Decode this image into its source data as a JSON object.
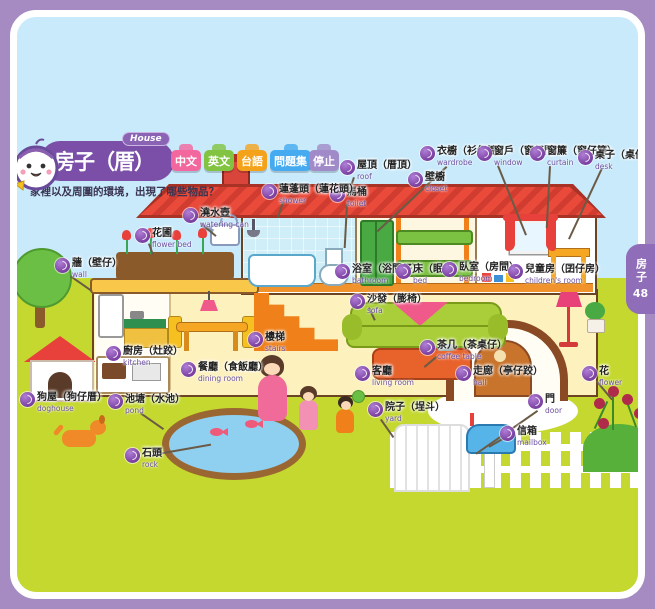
{
  "header": {
    "title": "房子（厝）",
    "title_en": "House",
    "subtitle": "家裡以及周圍的環境，出現了哪些物品？",
    "mascot_icon": "mascot-face",
    "buttons": [
      {
        "label": "中文",
        "color": "#f2679e"
      },
      {
        "label": "英文",
        "color": "#82c341"
      },
      {
        "label": "台語",
        "color": "#f5a21b"
      },
      {
        "label": "問題集",
        "color": "#45aaf0"
      },
      {
        "label": "停止",
        "color": "#a08bc8"
      }
    ]
  },
  "side_tab": {
    "title": "房子",
    "page_number": "48"
  },
  "labels": [
    {
      "zh": "屋頂（厝頂）",
      "en": "roof"
    },
    {
      "zh": "衣櫥（衫仔櫥）",
      "en": "wardrobe"
    },
    {
      "zh": "窗戶（窗仔門）",
      "en": "window"
    },
    {
      "zh": "窗簾（窗仔簾）",
      "en": "curtain"
    },
    {
      "zh": "桌子（桌仔）",
      "en": "desk"
    },
    {
      "zh": "壁櫥",
      "en": "closet"
    },
    {
      "zh": "馬桶",
      "en": "toilet"
    },
    {
      "zh": "蓮蓬頭（蓮花頭）",
      "en": "shower"
    },
    {
      "zh": "澆水壺",
      "en": "watering can"
    },
    {
      "zh": "花圃",
      "en": "flower bed"
    },
    {
      "zh": "牆（壁仔）",
      "en": "wall"
    },
    {
      "zh": "浴室（浴間仔）",
      "en": "bathroom"
    },
    {
      "zh": "床（眠床）",
      "en": "bed"
    },
    {
      "zh": "臥室（房間）",
      "en": "bedroom"
    },
    {
      "zh": "兒童房（囝仔房）",
      "en": "children's room"
    },
    {
      "zh": "沙發（膨椅）",
      "en": "sofa"
    },
    {
      "zh": "樓梯",
      "en": "stairs"
    },
    {
      "zh": "茶几（茶桌仔）",
      "en": "coffee table"
    },
    {
      "zh": "廚房（灶跤）",
      "en": "kitchen"
    },
    {
      "zh": "餐廳（食飯廳）",
      "en": "dining room"
    },
    {
      "zh": "客廳",
      "en": "living room"
    },
    {
      "zh": "走廊（亭仔跤）",
      "en": "hall"
    },
    {
      "zh": "花",
      "en": "flower"
    },
    {
      "zh": "門",
      "en": "door"
    },
    {
      "zh": "狗屋（狗仔厝）",
      "en": "doghouse"
    },
    {
      "zh": "池塘（水池）",
      "en": "pond"
    },
    {
      "zh": "石頭",
      "en": "rock"
    },
    {
      "zh": "院子（埕斗）",
      "en": "yard"
    },
    {
      "zh": "信箱",
      "en": "mailbox"
    }
  ],
  "colors": {
    "page_background": "#a58bc2",
    "banner": "#7b4fa8",
    "sky": "#c8eafb",
    "grass": "#c5d82f",
    "roof": "#ea4a3a",
    "audio_icon": "#8a4fa8"
  }
}
